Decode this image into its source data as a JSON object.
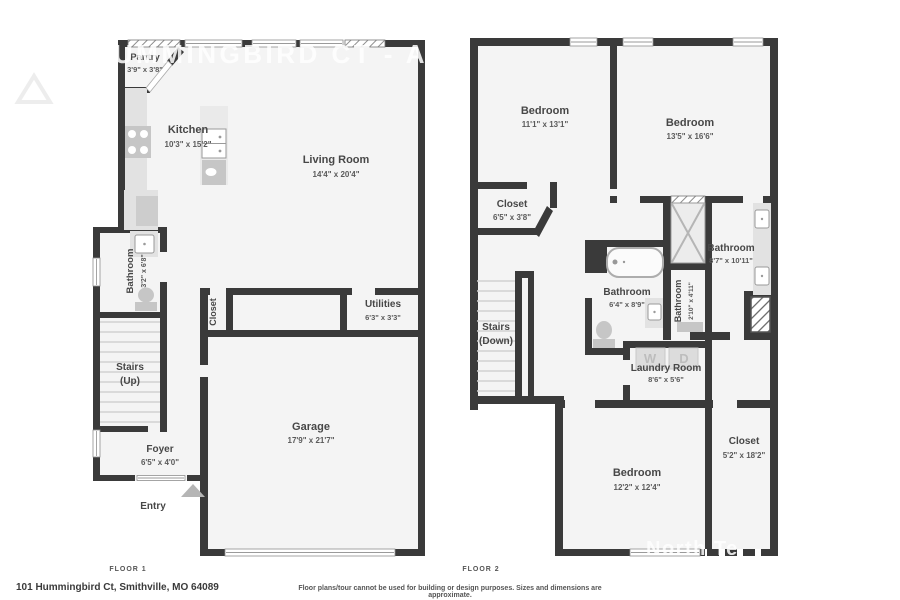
{
  "watermarks": {
    "title": "101 HUMMINGBIRD CT - A",
    "logo": "North Te"
  },
  "floor1": {
    "rooms": {
      "pantry": {
        "name": "Pantry",
        "dims": "3'9\" x 3'8\""
      },
      "kitchen": {
        "name": "Kitchen",
        "dims": "10'3\" x 15'2\""
      },
      "living": {
        "name": "Living Room",
        "dims": "14'4\" x 20'4\""
      },
      "bathroom": {
        "name": "Bathroom",
        "dims": "3'2\" x 6'8\""
      },
      "closet": {
        "name": "Closet"
      },
      "utilities": {
        "name": "Utilities",
        "dims": "6'3\" x 3'3\""
      },
      "stairs": {
        "name": "Stairs",
        "sub": "(Up)"
      },
      "foyer": {
        "name": "Foyer",
        "dims": "6'5\" x 4'0\""
      },
      "entry": {
        "name": "Entry"
      },
      "garage": {
        "name": "Garage",
        "dims": "17'9\" x 21'7\""
      }
    }
  },
  "floor2": {
    "rooms": {
      "bedroom_a": {
        "name": "Bedroom",
        "dims": "11'1\" x 13'1\""
      },
      "bedroom_b": {
        "name": "Bedroom",
        "dims": "13'5\" x 16'6\""
      },
      "closet_a": {
        "name": "Closet",
        "dims": "6'5\" x 3'8\""
      },
      "stairs": {
        "name": "Stairs",
        "sub": "(Down)"
      },
      "bathroom_a": {
        "name": "Bathroom",
        "dims": "6'4\" x 8'9\""
      },
      "bathroom_b": {
        "name": "Bathroom",
        "dims": "2'10\" x 4'11\""
      },
      "bathroom_c": {
        "name": "Bathroom",
        "dims": "8'7\" x 10'11\""
      },
      "laundry": {
        "name": "Laundry Room",
        "dims": "8'6\" x 5'6\""
      },
      "washer_label": "W",
      "dryer_label": "D",
      "bedroom_c": {
        "name": "Bedroom",
        "dims": "12'2\" x 12'4\""
      },
      "closet_b": {
        "name": "Closet",
        "dims": "5'2\" x 18'2\""
      }
    }
  },
  "footer": {
    "floor1_label": "FLOOR 1",
    "floor2_label": "FLOOR 2",
    "address": "101 Hummingbird Ct, Smithville, MO 64089",
    "disclaimer": "Floor plans/tour cannot be used for building or design purposes. Sizes and dimensions are approximate."
  },
  "colors": {
    "wall": "#3a3a3a",
    "floor_fill": "#f4f4f4",
    "fixture_light": "#e2e2e2",
    "fixture_mid": "#c6c6c6",
    "label_text": "#474747",
    "watermark": "#ffffff"
  }
}
